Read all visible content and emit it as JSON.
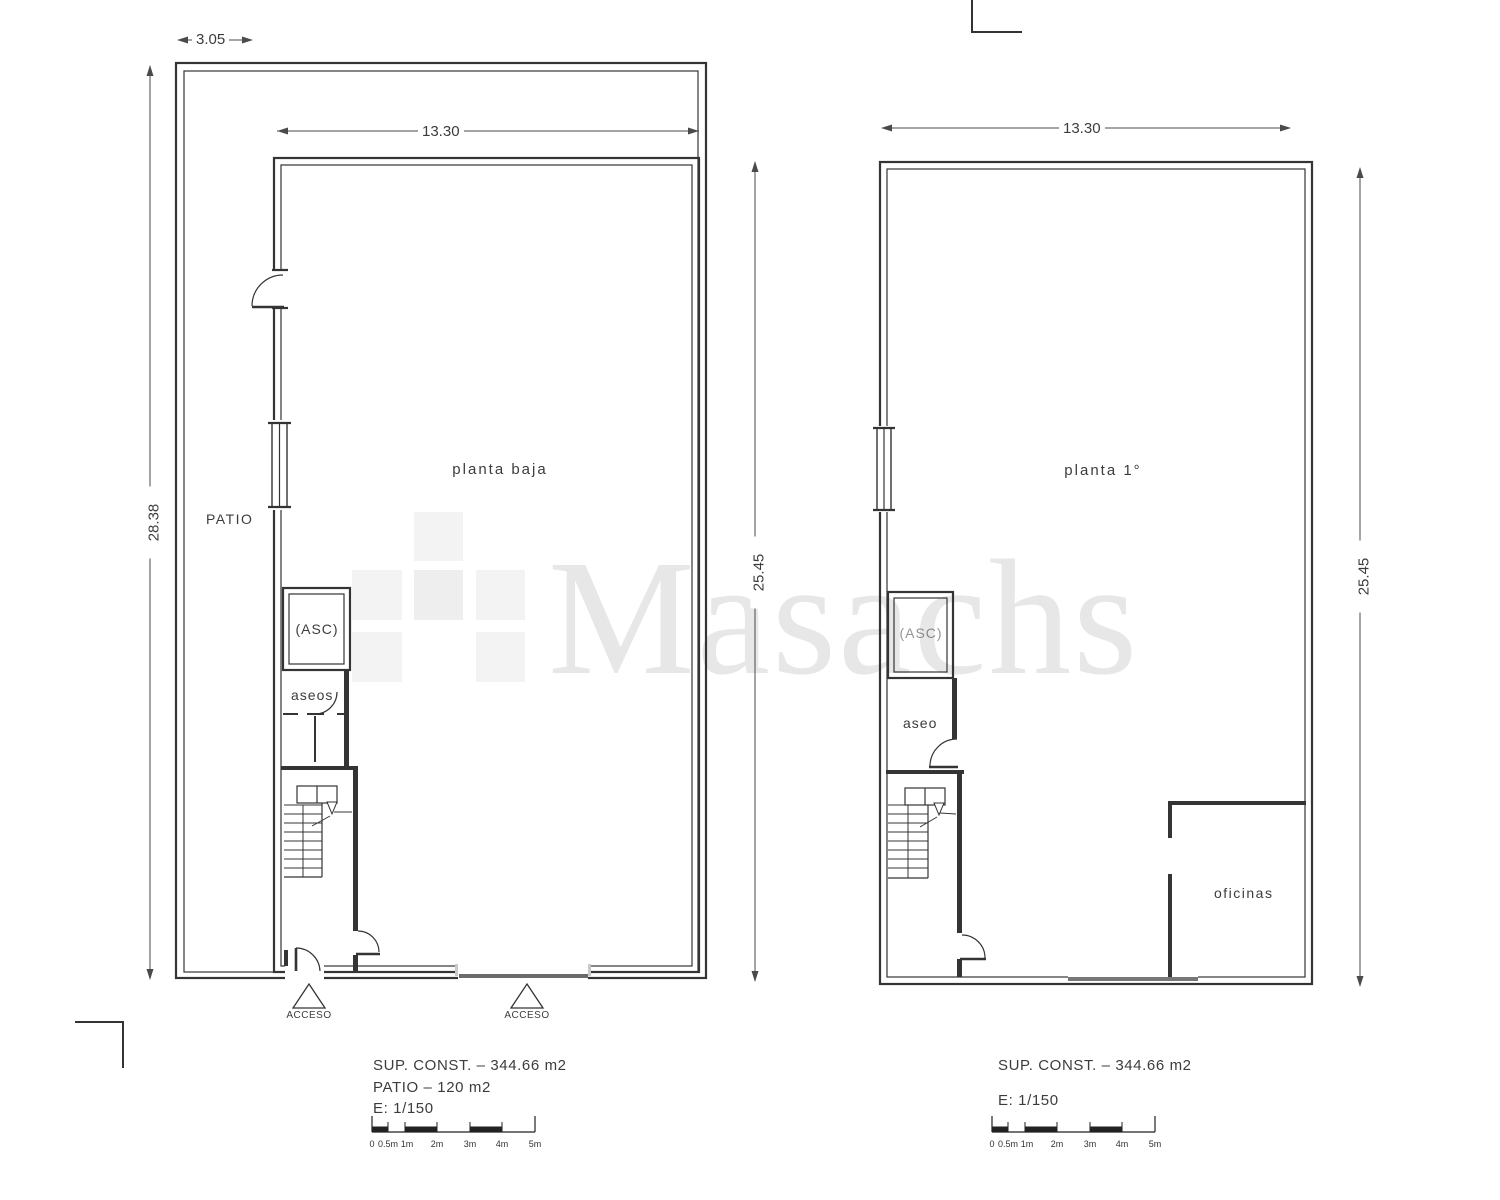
{
  "watermark": {
    "text": "Masachs"
  },
  "left_plan": {
    "title": "planta baja",
    "patio_label": "PATIO",
    "elevator_label": "(ASC)",
    "wc_label": "aseos",
    "access1_label": "ACCESO",
    "access2_label": "ACCESO",
    "dim_patio_width": "3.05",
    "dim_building_width": "13.30",
    "dim_total_height": "28.38",
    "dim_building_height": "25.45",
    "info_line1": "SUP. CONST. – 344.66 m2",
    "info_line2": "PATIO – 120 m2",
    "info_line3": "E: 1/150",
    "scale_labels": [
      "0",
      "0.5m",
      "1m",
      "2m",
      "3m",
      "4m",
      "5m"
    ]
  },
  "right_plan": {
    "title": "planta 1°",
    "elevator_label": "(ASC)",
    "wc_label": "aseo",
    "office_label": "oficinas",
    "dim_building_width": "13.30",
    "dim_building_height": "25.45",
    "info_line1": "SUP. CONST. – 344.66 m2",
    "info_line2": "E: 1/150",
    "scale_labels": [
      "0",
      "0.5m",
      "1m",
      "2m",
      "3m",
      "4m",
      "5m"
    ]
  }
}
